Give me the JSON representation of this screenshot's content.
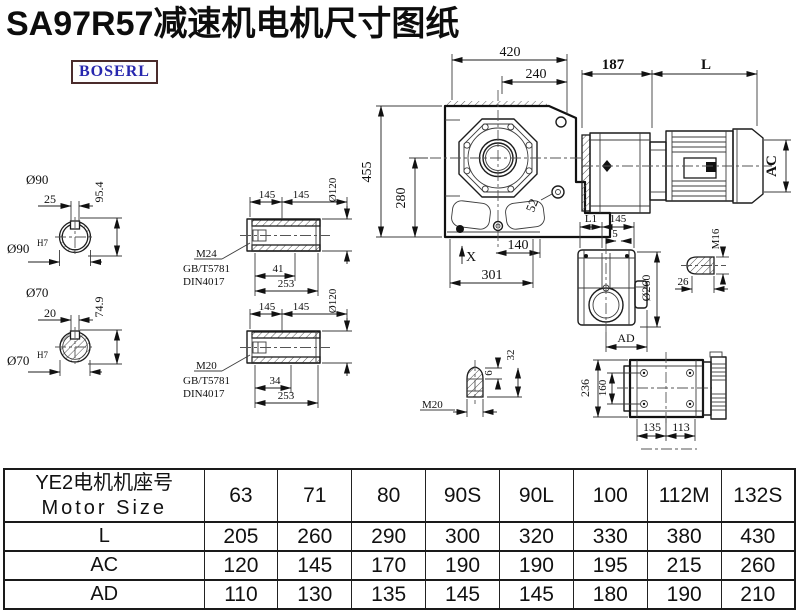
{
  "title": "SA97R57减速机电机尺寸图纸",
  "logo": {
    "text": "BOSERL"
  },
  "annotations": {
    "front": {
      "d420": "420",
      "d240": "240",
      "d455": "455",
      "d280": "280",
      "d140": "140",
      "d301": "301",
      "d52": "52",
      "x_mark": "X"
    },
    "motor": {
      "d187": "187",
      "dL": "L",
      "dAC": "AC"
    },
    "s90": {
      "title": "Ø90",
      "d25": "25",
      "d954": "95.4",
      "bore": "Ø90",
      "tol": "H7"
    },
    "s70": {
      "title": "Ø70",
      "d20": "20",
      "d749": "74.9",
      "bore": "Ø70",
      "tol": "H7"
    },
    "hu": {
      "d145": "145",
      "dia": "Ø120",
      "thread": "M24",
      "std1": "GB/T5781",
      "std2": "DIN4017",
      "d41": "41",
      "d253": "253"
    },
    "hl": {
      "d145": "145",
      "dia": "Ø120",
      "thread": "M20",
      "std1": "GB/T5781",
      "std2": "DIN4017",
      "d34": "34",
      "d253": "253"
    },
    "side": {
      "dL1": "L1",
      "d145": "145",
      "d5": "5",
      "dia": "Ø260",
      "dAD": "AD"
    },
    "sh": {
      "thread": "M16",
      "d26": "26"
    },
    "sv": {
      "thread": "M20",
      "d6": "6",
      "d32": "32"
    },
    "tv": {
      "d236": "236",
      "d160": "160",
      "d135": "135",
      "d113": "113"
    }
  },
  "table": {
    "header_cn": "YE2电机机座号",
    "header_en": "Motor Size",
    "columns": [
      "63",
      "71",
      "80",
      "90S",
      "90L",
      "100",
      "112M",
      "132S"
    ],
    "rows": [
      {
        "label": "L",
        "values": [
          "205",
          "260",
          "290",
          "300",
          "320",
          "330",
          "380",
          "430"
        ]
      },
      {
        "label": "AC",
        "values": [
          "120",
          "145",
          "170",
          "190",
          "190",
          "195",
          "215",
          "260"
        ]
      },
      {
        "label": "AD",
        "values": [
          "110",
          "130",
          "135",
          "145",
          "145",
          "180",
          "190",
          "210"
        ]
      }
    ]
  },
  "colors": {
    "accent_logo": "#2626ae",
    "logo_border": "#4a2b2b",
    "line": "#1c1c1c"
  }
}
